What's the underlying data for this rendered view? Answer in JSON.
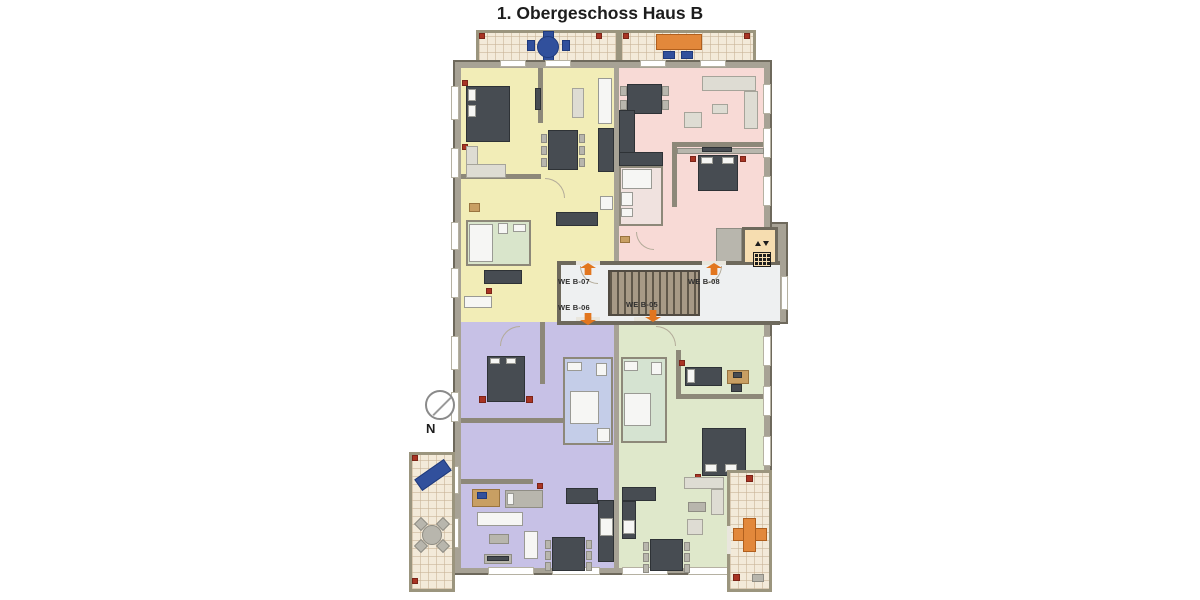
{
  "title": "1. Obergeschoss Haus B",
  "units": [
    {
      "label": "WE B-07",
      "color": "#f2edb7",
      "position": "top-left",
      "entrance_arrow": "up"
    },
    {
      "label": "WE B-08",
      "color": "#f8dad6",
      "position": "top-right",
      "entrance_arrow": "up"
    },
    {
      "label": "WE B-06",
      "color": "#c7c1e6",
      "position": "bottom-left",
      "entrance_arrow": "down"
    },
    {
      "label": "WE B-05",
      "color": "#dfe8cb",
      "position": "bottom-right",
      "entrance_arrow": "down"
    }
  ],
  "compass": {
    "label": "N"
  },
  "colors": {
    "wall_fill": "#a7a295",
    "wall_line": "#6e695c",
    "corridor": "#eef0f1",
    "entrance_arrow": "#e2761e",
    "elevator_room": "#f6ddb0",
    "balcony_tile": "#f3ead9",
    "stairs": "#a79a86",
    "bath_yellow_unit": "#d9e5cb",
    "bath_pink_unit": "#f0e2df",
    "bath_purple_unit": "#c4cde8",
    "bath_green_unit": "#d5e3d1"
  },
  "icons": {
    "elevator": "elevator-icon",
    "compass_north": "compass-icon",
    "entrance_arrow": "arrow-icon",
    "flower_pot": "flower-pot-icon",
    "staircase": "staircase-icon"
  }
}
